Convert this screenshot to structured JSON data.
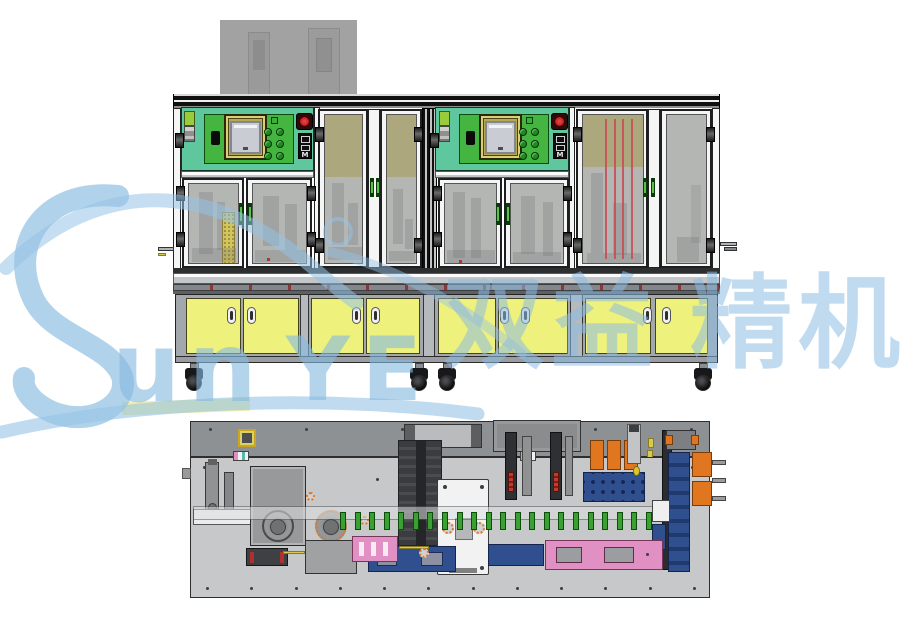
{
  "watermark": {
    "logo_letter": "S",
    "latin_lower": "un",
    "latin_upper": "YE",
    "brand": "Sunye",
    "cjk": [
      "双",
      "益",
      "精",
      "机"
    ],
    "blue": "#86b9e0",
    "yellow_bar": "#eeeca2"
  },
  "colors": {
    "teal-panel": "#5ec79d",
    "green-panel": "#45b542",
    "hmi-frame": "#d9cf7b",
    "hmi-screen": "#c9ccd3",
    "glass": "#b4b6b3",
    "glass-tan": "#aca577",
    "frame-white": "#f4f5f4",
    "rail-gray": "#b7bbbe",
    "cabinet-yellow": "#eef17c",
    "cabinet-frame": "#a3a8ac",
    "handle-green": "#5fc047",
    "estop-red": "#c32222",
    "tower-green": "#9acb3d",
    "plate-gray": "#c6c8ca",
    "strip-gray": "#8e9193",
    "orange": "#e0761f",
    "navy": "#2f4f8e",
    "pink": "#e090c2",
    "pin-green": "#3aa032",
    "box-gray": "#98999b",
    "background-gray": "#a2a2a2"
  },
  "front_view": {
    "station_count": 2,
    "switch_label": "M",
    "hmi_button_count": 6,
    "red_glass_line_count": 4,
    "cabinet_door_count": 8,
    "caster_count": 4
  },
  "top_view": {
    "green_pin_count": 22,
    "strip_screw_count": 6,
    "plate_screw_count": 12,
    "yellow_bracket_count": 2
  }
}
